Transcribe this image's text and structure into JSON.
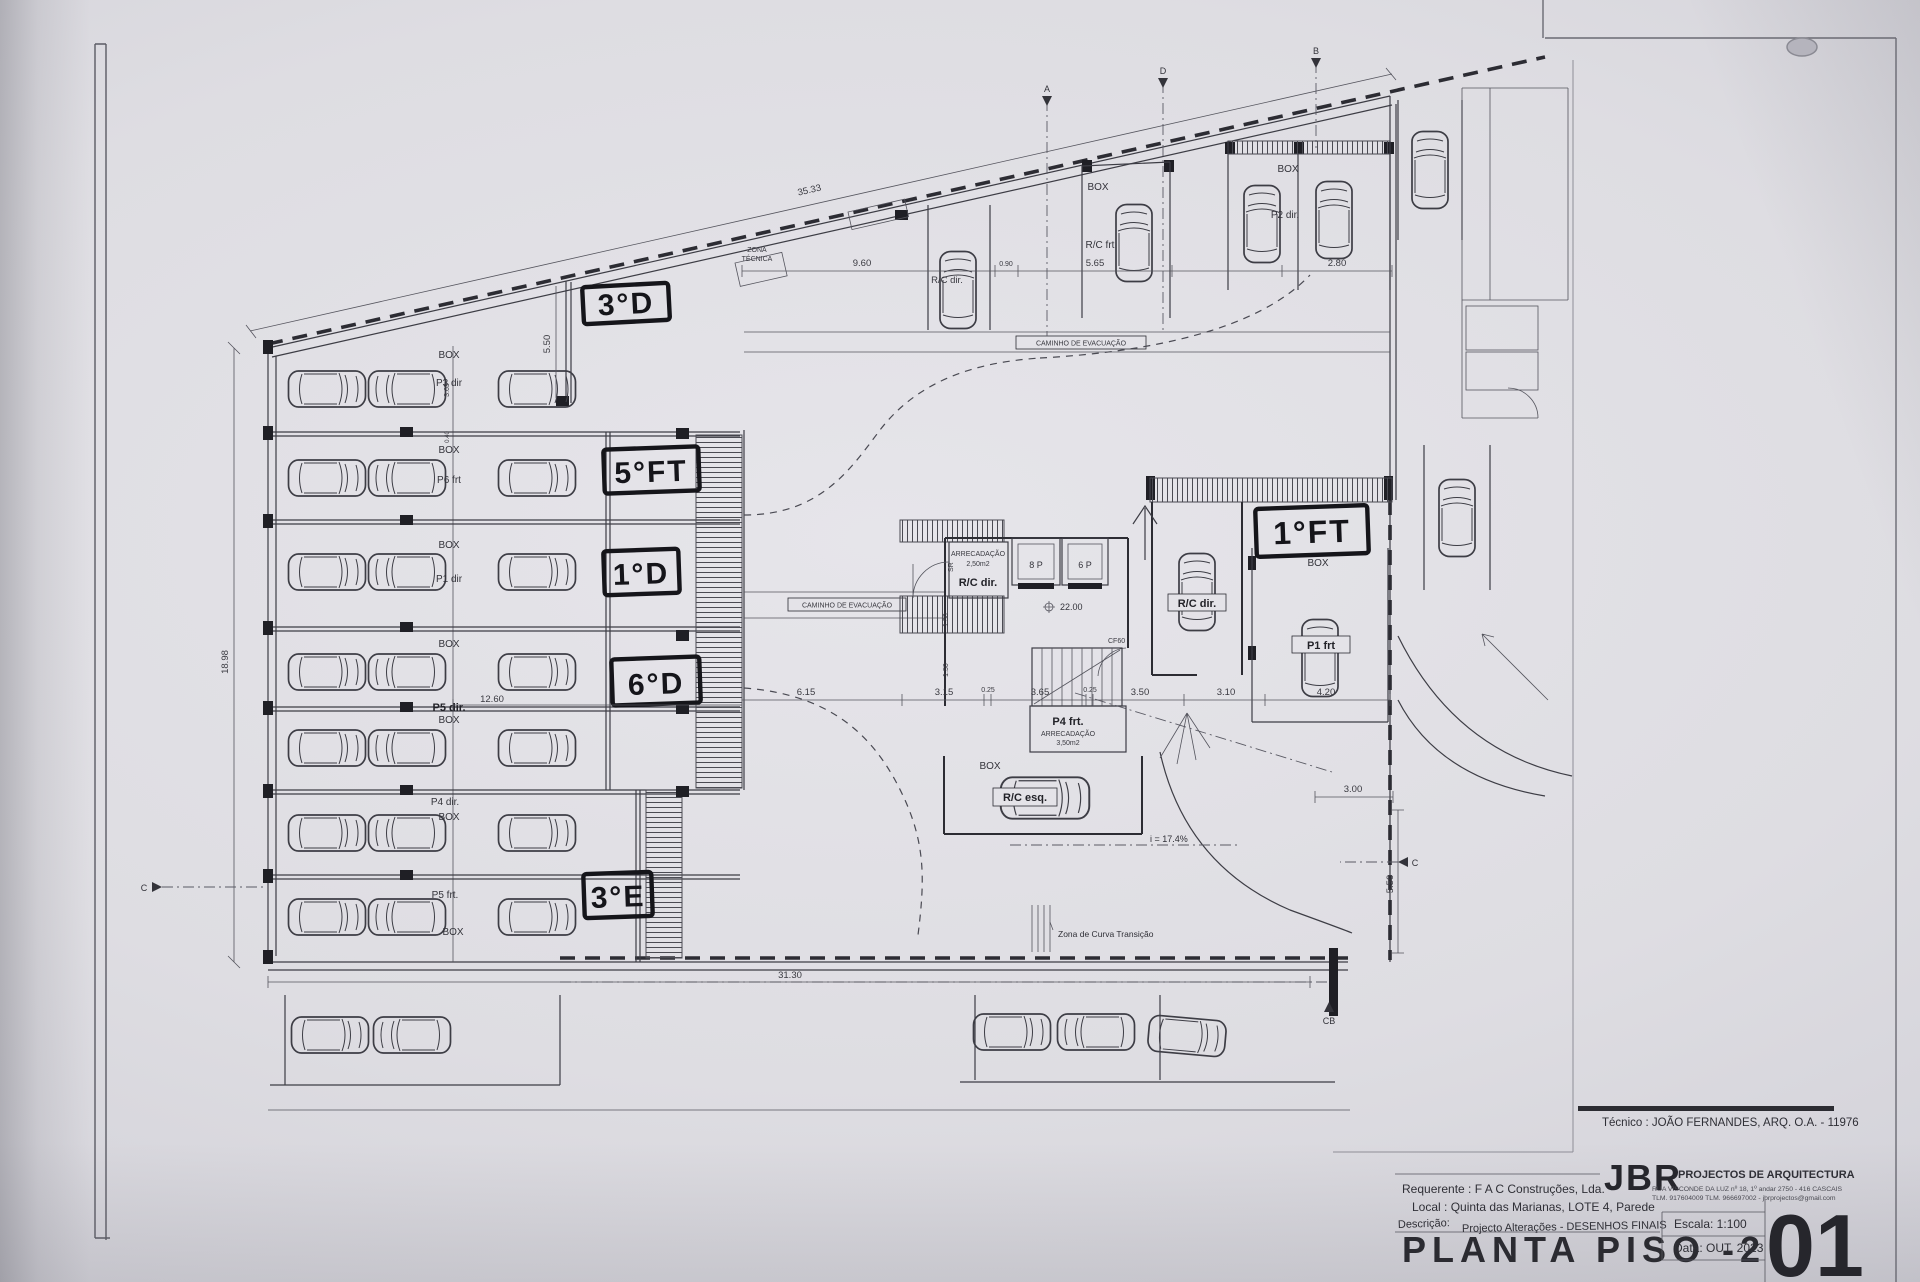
{
  "title_block": {
    "tecnico": "Técnico : JOÃO FERNANDES, ARQ.   O.A. - 11976",
    "firm_logo": "JBR",
    "firm_name": "PROJECTOS DE ARQUITECTURA",
    "firm_address": "RUA VISCONDE DA LUZ nº 18, 1º andar  2750 - 416  CASCAIS",
    "firm_contacts": "TLM. 917604009  TLM. 966697002 - jbrprojectos@gmail.com",
    "requerente": "Requerente : F A C  Construções, Lda.",
    "local": "Local : Quinta das Marianas, LOTE 4, Parede",
    "descricao_label": "Descrição:",
    "descricao": "Projecto Alterações - DESENHOS FINAIS",
    "drawing_title": "PLANTA PISO -2",
    "escala": "Escala:  1:100",
    "data": "Data: OUT.  2023",
    "sheet_number": "01"
  },
  "handwritten": {
    "r1": "3°D",
    "r2": "5°FT",
    "r3": "1°D",
    "r4": "6°D",
    "r7": "3°E",
    "right": "1°FT"
  },
  "stalls": [
    {
      "box": "BOX",
      "label": "P3 dir"
    },
    {
      "box": "BOX",
      "label": "P6 frt"
    },
    {
      "box": "BOX",
      "label": "P1 dir"
    },
    {
      "box": "BOX",
      "label": "P5 dir."
    },
    {
      "box": "BOX",
      "label": "P4 dir."
    },
    {
      "box": "BOX",
      "label": "P5 frt."
    },
    {
      "box": "BOX",
      "label": ""
    }
  ],
  "bays": {
    "top_mid_box": "BOX",
    "top_mid_unit": "R/C frt",
    "top_right_box": "BOX",
    "top_right_unit": "P2 dir.",
    "ramp_car_unit": "R/C dir.",
    "center_bay_unit": "R/C dir.",
    "right_bay_box": "BOX",
    "right_bay_unit": "P1 frt",
    "bottom_bay_box": "BOX",
    "bottom_bay_unit": "R/C esq."
  },
  "core": {
    "arrec1_title": "ARRECADAÇÃO",
    "arrec1_code": "SR",
    "arrec1_area": "2,50m2",
    "arrec1_unit": "R/C dir.",
    "lift_left": "8 P",
    "lift_right": "6 P",
    "level": "22.00",
    "door": "CF60",
    "arrec2_stall": "P4 frt.",
    "arrec2_title": "ARRECADAÇÃO",
    "arrec2_area": "3,50m2"
  },
  "notes": {
    "zona_1": "ZONA",
    "zona_2": "TÉCNICA",
    "caminho_top": "CAMINHO DE EVACUAÇÃO",
    "caminho_left": "CAMINHO DE EVACUAÇÃO",
    "curva": "Zona de Curva Transição",
    "slope": "i = 17.4%"
  },
  "dims": {
    "diag": "35.33",
    "left_total": "18.98",
    "row_width": "12.60",
    "bottom_total": "31.30",
    "top_line": [
      "9.60",
      "0.90",
      "5.65",
      "2.80"
    ],
    "mid": [
      "6.15",
      "3.15",
      "0.25",
      "3.65",
      "0.25",
      "3.50",
      "3.10",
      "4.20"
    ],
    "right_v": "5.50",
    "upper_left_v": "5.50",
    "short_h": "3.00",
    "stall_depth": "3.65",
    "wall": "0.40",
    "core_a": "1.50",
    "core_b": "1.50"
  },
  "markers": {
    "top_a": "A",
    "top_d": "D",
    "top_b": "B",
    "left_c": "C",
    "right_c": "C",
    "bottom_cb": "CB"
  }
}
